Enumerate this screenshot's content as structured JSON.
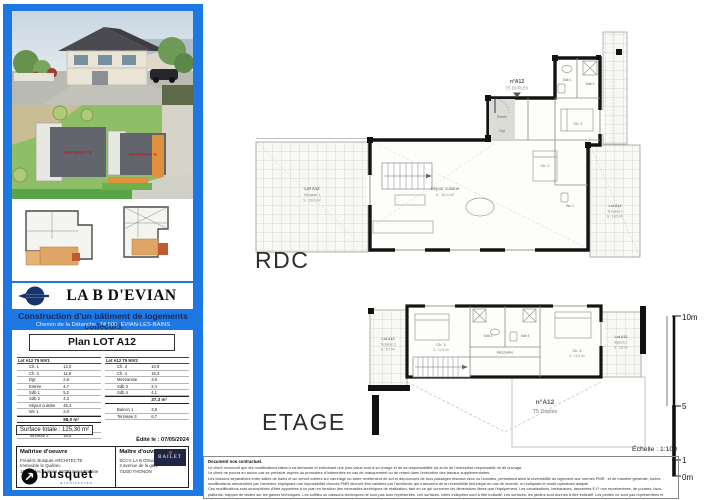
{
  "sidebar": {
    "title": "LA B D'EVIAN",
    "subtitle": "Construction d'un bâtiment de logements collectifs",
    "address": "Chemin de la Détanche, 74 500, EVIAN-LES-BAINS",
    "site_plan": {
      "building_b": "BATIMENT B",
      "building_a": "BATIMENT A"
    },
    "plan_title": "Plan LOT A12",
    "tables": [
      {
        "title": "Lot A12 T5 NIV1",
        "rows": [
          [
            "Ch. 1",
            "12,0"
          ],
          [
            "Ch. 2",
            "11,9"
          ],
          [
            "Dgt",
            "2,8"
          ],
          [
            "Entrée",
            "4,7"
          ],
          [
            "Sdb 1",
            "5,2"
          ],
          [
            "Sdb 2",
            "4,3"
          ],
          [
            "Séjour cuisine",
            "45,4"
          ],
          [
            "Wc 1",
            "2,0"
          ]
        ],
        "total": "88,0 m²",
        "extras": [
          [
            "Terrasse 1",
            "29,0"
          ],
          [
            "Terrasse 2",
            "18,5"
          ]
        ]
      },
      {
        "title": "Lot A12 T5 NIV2",
        "rows": [
          [
            "Ch. 3",
            "10,9"
          ],
          [
            "Ch. 4",
            "15,3"
          ],
          [
            "Mezzanine",
            "3,6"
          ],
          [
            "Sdb 3",
            "2,4"
          ],
          [
            "Sdb 4",
            "4,1"
          ]
        ],
        "total": "37,3 m²",
        "extras": [
          [
            "Balcon 1",
            "3,8"
          ],
          [
            "Terrasse 3",
            "6,7"
          ]
        ]
      }
    ],
    "surface_total": "Surface totale : 125,30 m²",
    "edited": "Édité le : 07/05/2024",
    "moe": {
      "title": "Maîtrise d'oeuvre",
      "lines": [
        "Frédéric Busquet ARCHITECTE",
        "Immeuble le Québec",
        "16 rue des Aciéries 42000 Saint-Etienne"
      ],
      "logo_text": "busquet",
      "logo_sub": "architectes"
    },
    "moa": {
      "title": "Maître d'ouvrage",
      "lines": [
        "SCCV LA B D'Evian",
        "2 avenue de la gare",
        "74200 THONON"
      ],
      "logo_text": "BAILET"
    }
  },
  "main": {
    "rdc_label": "RDC",
    "etage_label": "ETAGE",
    "scale": {
      "top": "10m",
      "mid": "5",
      "one": "1",
      "bottom": "0m",
      "text": "Échelle : 1:100"
    },
    "rdc_plan": {
      "unit_label": "n°A12",
      "unit_type": "T5 DUPLEX",
      "rooms": {
        "sejour": "Séjour cuisine",
        "sejour_area": "S : 45,4 m²",
        "ch1": "Ch. 1",
        "ch2": "Ch. 2",
        "sdb1": "Sdb 1",
        "sdb2": "Sdb 2",
        "wc1": "Wc 1",
        "entree": "Entrée",
        "dgt": "Dgt"
      },
      "terrasse1": [
        "Lot A12",
        "Terrasse 1",
        "S : 29,0 m²"
      ],
      "terrasse2": [
        "Lot A12",
        "Terrasse 2",
        "S : 18,5 m²"
      ]
    },
    "etage_plan": {
      "unit_label": "n°A12",
      "unit_type": "T5 Duplex",
      "rooms": {
        "ch3": "Ch. 3",
        "ch3_area": "S : 10,9 m²",
        "ch4": "Ch. 4",
        "ch4_area": "S : 15,3 m²",
        "sdb3": "Sdb 3",
        "sdb4": "Sdb 4",
        "mezzanine": "Mezzanine"
      },
      "terrasse3": [
        "Lot A12",
        "Terrasse 3",
        "S : 6,7 m²"
      ],
      "balcon1": [
        "Lot A12",
        "Balcon 1",
        "S : 3,8 m²"
      ]
    },
    "legal": {
      "title": "Document non contractuel.",
      "lines": [
        "Le client reconnaît que les modifications faites à sa demande et entraînant une plus-value sont à sa charge et de sa responsabilité vis-à-vis de l'entreprise responsable du dit ouvrage.",
        "Le client ne pourra en aucun cas se prévaloir auprès du promoteur d'indemnités en cas de manquement ou de retard dans l'exécution des travaux supplémentaires.",
        "Les cloisons séparatives entre salles de bains et wc seront collées sur carrelage ou autre revêtement de sol et dépourvues de tous passages réseaux secs ou humides, permettant ainsi la réversibilité du logement aux normes PMR ; et de manière générale, toutes modifications demandées par l'acheteur impliquant une impossibilité d'accès PMR devront être validées par l'architecte qui s'assurera de la réversibilité technique en cas de revente, en indiquant le mode opératoire adapté.",
        "Ces modifications sont susceptibles d'être apportées à ce plan en fonction des nécessités techniques de réalisation, tant en ce qui concerne les dimensions libres que l'équipement. Les canalisations, barbacanes, descentes E.P. non représentées, de poutres, faux-plafonds, trappes de visites sur les gaines techniques. Les soffites ou caissons techniques ne sont pas tous représentés. Les surfaces, côtes indiquées sont à titre indicatif. Les surfaces, les jardins sont donnés à titre indicatif. Les pentes ne sont pas représentées et seront adaptées en fonction du terrain naturel."
      ]
    }
  }
}
